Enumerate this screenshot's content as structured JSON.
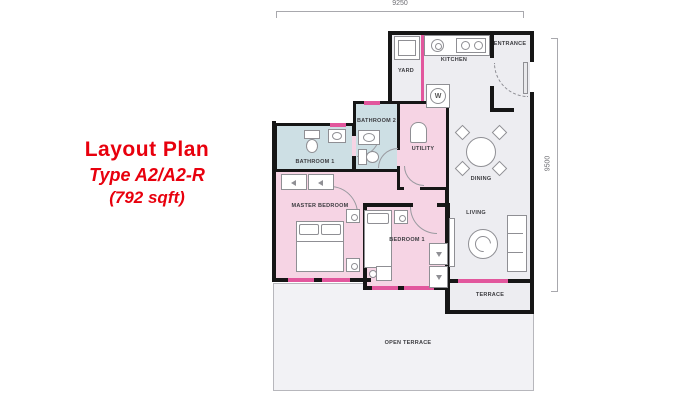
{
  "title": {
    "line1": "Layout Plan",
    "line2": "Type A2/A2-R",
    "line3": "(792 sqft)"
  },
  "dimensions": {
    "top": "9250",
    "right": "9500"
  },
  "rooms": {
    "yard": "YARD",
    "kitchen": "KITCHEN",
    "entrance": "ENTRANCE",
    "bathroom2": "BATHROOM 2",
    "bathroom1": "BATHROOM 1",
    "utility": "UTILITY",
    "dining": "DINING",
    "living": "LIVING",
    "master_bedroom": "MASTER BEDROOM",
    "bedroom1": "BEDROOM 1",
    "terrace": "TERRACE",
    "open_terrace": "OPEN TERRACE"
  },
  "icons": {
    "washer_label": "W"
  },
  "colors": {
    "accent_red": "#e8000d",
    "wall_black": "#161616",
    "window_pink": "#e2579d",
    "bedroom_pink": "#f6d4e4",
    "bathroom_blue": "#cddfe4",
    "floor_gray": "#ededf1",
    "open_terrace_gray": "#f2f2f5"
  }
}
